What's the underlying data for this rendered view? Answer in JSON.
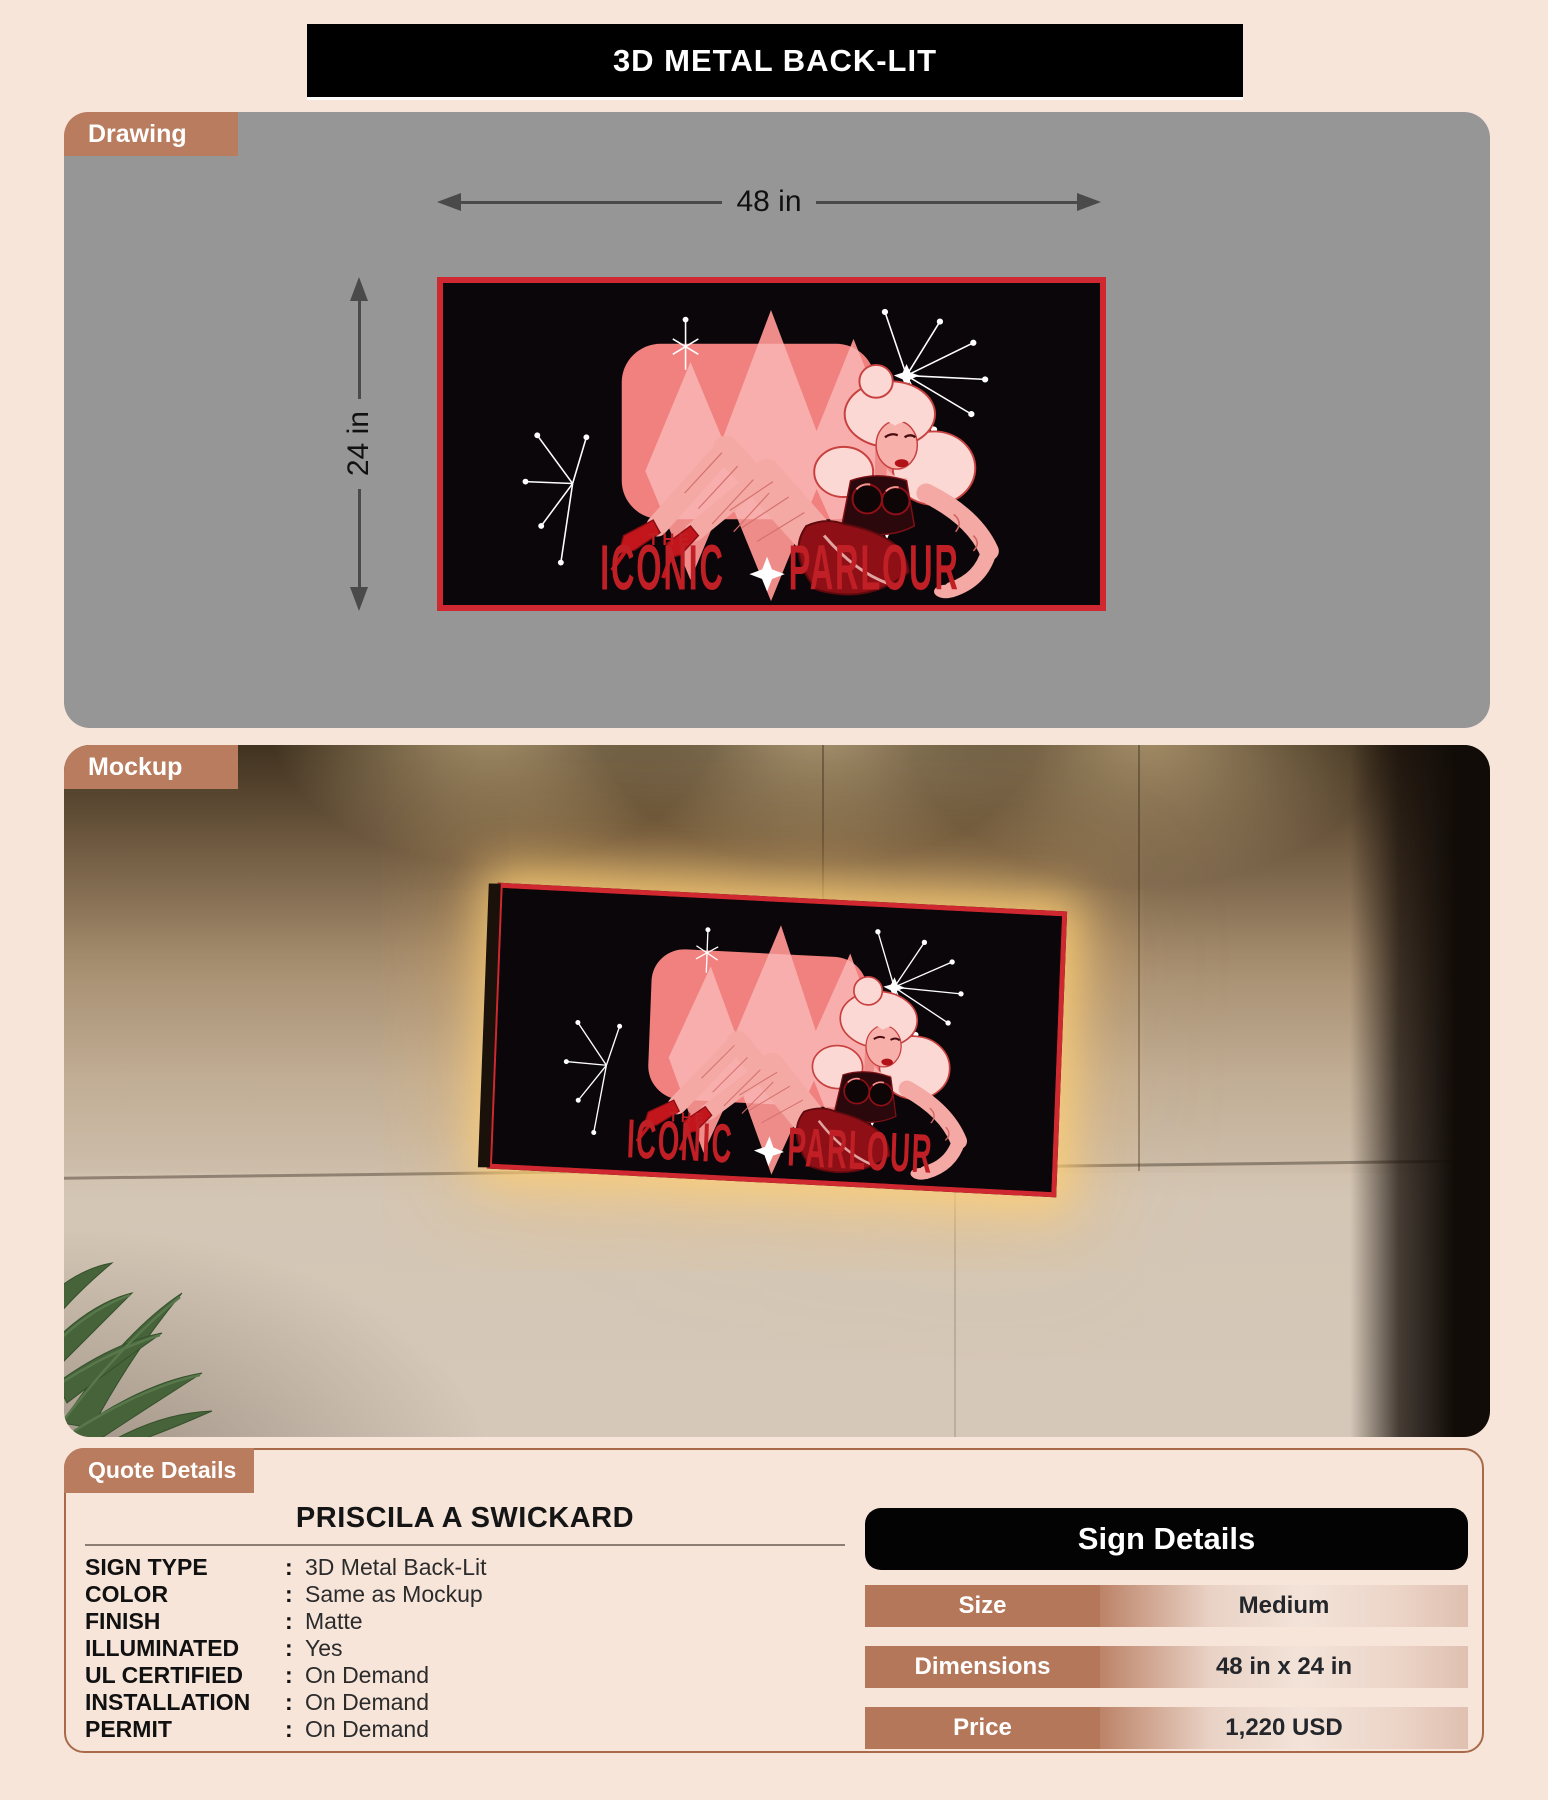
{
  "colors": {
    "background": "#f7e5da",
    "accent_brown": "#b97c5e",
    "accent_red": "#cf2830",
    "panel_gray": "#969696",
    "table_black": "#030303"
  },
  "header": {
    "title": "3D METAL BACK-LIT"
  },
  "drawing": {
    "tab_label": "Drawing",
    "width_label": "48 in",
    "height_label": "24 in"
  },
  "artwork": {
    "word_the": "THE",
    "word_iconic": "ICONIC",
    "word_parlour": "PARLOUR"
  },
  "mockup": {
    "tab_label": "Mockup"
  },
  "quote": {
    "tab_label": "Quote Details",
    "customer_name": "PRISCILA A SWICKARD",
    "fields": [
      {
        "label": "SIGN TYPE",
        "value": "3D Metal Back-Lit"
      },
      {
        "label": "COLOR",
        "value": "Same as Mockup"
      },
      {
        "label": "FINISH",
        "value": "Matte"
      },
      {
        "label": "ILLUMINATED",
        "value": "Yes"
      },
      {
        "label": "UL CERTIFIED",
        "value": "On Demand"
      },
      {
        "label": "INSTALLATION",
        "value": "On Demand"
      },
      {
        "label": "PERMIT",
        "value": "On Demand"
      }
    ]
  },
  "sign_details": {
    "title": "Sign Details",
    "rows": [
      {
        "label": "Size",
        "value": "Medium"
      },
      {
        "label": "Dimensions",
        "value": "48 in x 24 in"
      },
      {
        "label": "Price",
        "value": "1,220 USD"
      }
    ]
  }
}
